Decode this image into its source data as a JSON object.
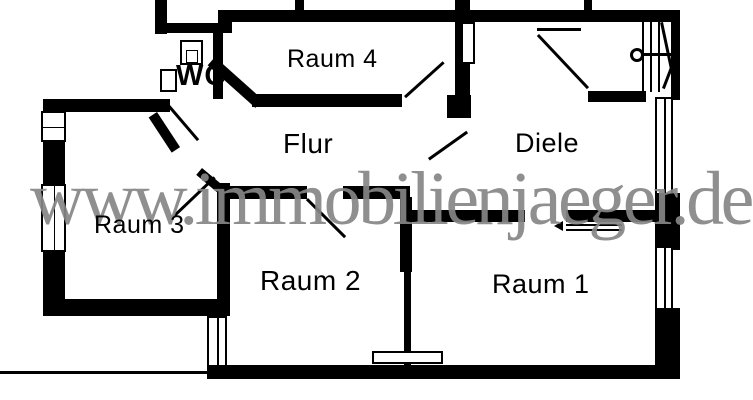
{
  "plan": {
    "watermark": "www.immobilienjaeger.de",
    "rooms": [
      {
        "name": "Raum 4"
      },
      {
        "name": "WC"
      },
      {
        "name": "Flur"
      },
      {
        "name": "Diele"
      },
      {
        "name": "Raum 3"
      },
      {
        "name": "Raum 2"
      },
      {
        "name": "Raum 1"
      }
    ],
    "colors": {
      "wall": "#000000",
      "background": "#ffffff",
      "watermark": "#868686"
    },
    "features": [
      "staircase",
      "windows",
      "doors",
      "toilet",
      "washbasin",
      "radiator"
    ]
  }
}
